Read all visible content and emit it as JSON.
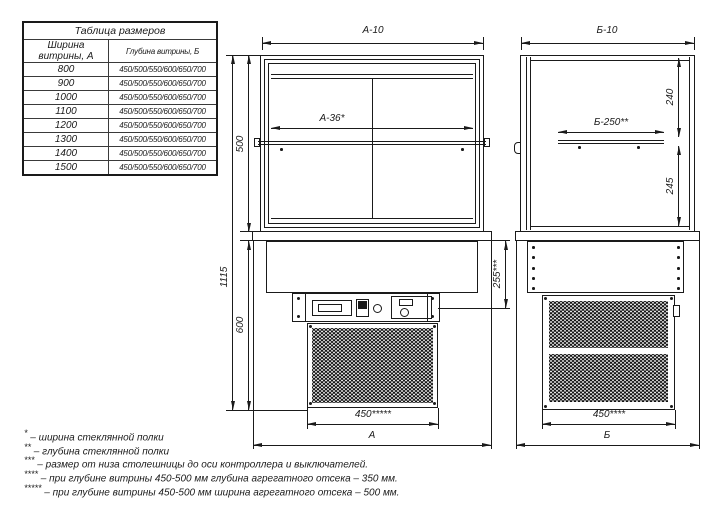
{
  "size_table": {
    "title": "Таблица размеров",
    "columns": [
      "Ширина витрины, А",
      "Глубина витрины, Б"
    ],
    "rows": [
      {
        "width": "800",
        "depth": "450/500/550/600/650/700"
      },
      {
        "width": "900",
        "depth": "450/500/550/600/650/700"
      },
      {
        "width": "1000",
        "depth": "450/500/550/600/650/700"
      },
      {
        "width": "1100",
        "depth": "450/500/550/600/650/700"
      },
      {
        "width": "1200",
        "depth": "450/500/550/600/650/700"
      },
      {
        "width": "1300",
        "depth": "450/500/550/600/650/700"
      },
      {
        "width": "1400",
        "depth": "450/500/550/600/650/700"
      },
      {
        "width": "1500",
        "depth": "450/500/550/600/650/700"
      }
    ]
  },
  "front_view": {
    "dims": {
      "top_width": "А-10",
      "inner_width": "А-36*",
      "glass_height": "500",
      "total_height": "1115",
      "base_height": "600",
      "controller_offset": "255***",
      "unit_width": "450*****",
      "overall_width": "А"
    }
  },
  "side_view": {
    "dims": {
      "top_depth": "Б-10",
      "shelf_depth": "Б-250**",
      "above_shelf": "240",
      "below_shelf": "245",
      "unit_depth": "450****",
      "overall_depth": "Б"
    }
  },
  "footnotes": [
    {
      "marker": "*",
      "text": "– ширина стеклянной полки"
    },
    {
      "marker": "**",
      "text": "– глубина стеклянной полки"
    },
    {
      "marker": "***",
      "text": "– размер от низа столешницы до оси контроллера и выключателей."
    },
    {
      "marker": "****",
      "text": "– при глубине витрины 450-500 мм глубина агрегатного отсека – 350 мм."
    },
    {
      "marker": "*****",
      "text": "– при глубине витрины 450-500 мм ширина агрегатного отсека – 500 мм."
    }
  ],
  "colors": {
    "line": "#1a1a1a",
    "background": "#ffffff"
  }
}
